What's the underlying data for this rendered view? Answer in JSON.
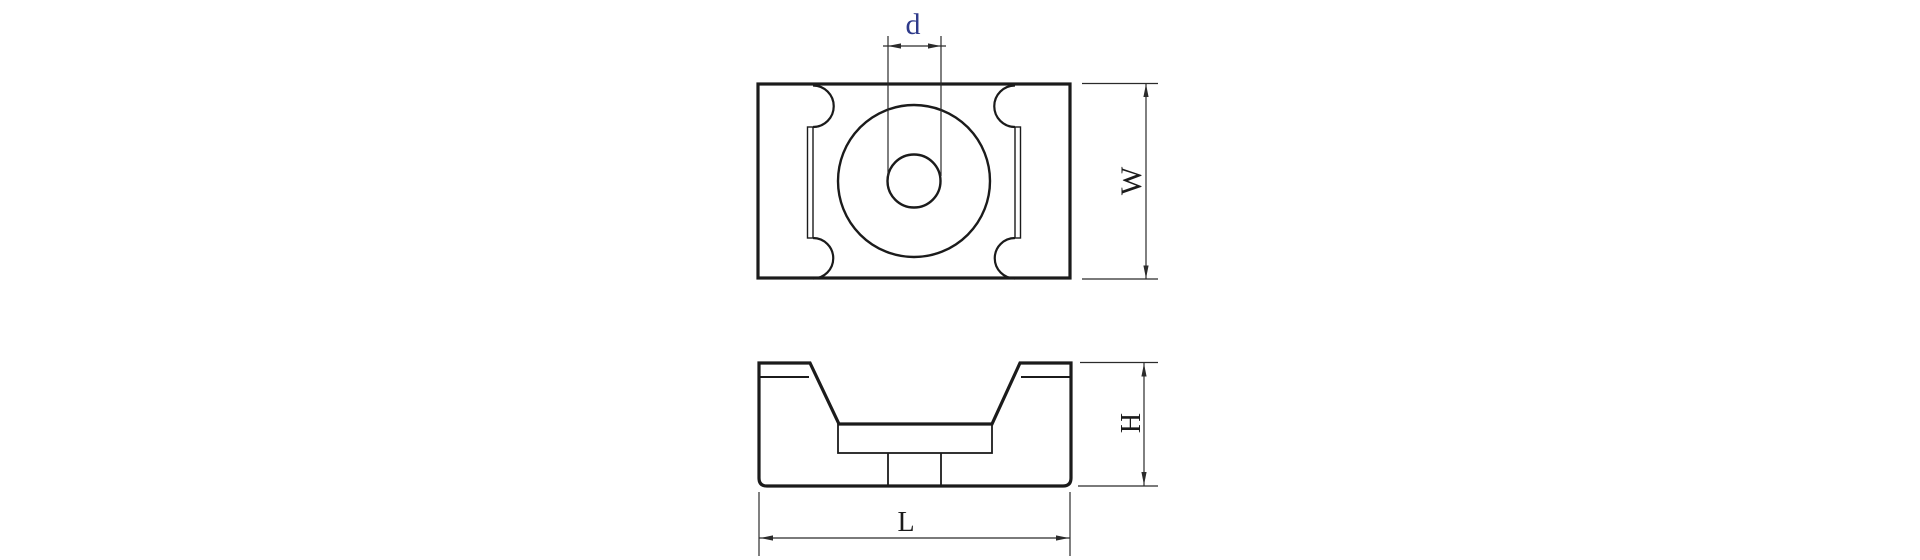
{
  "figure": {
    "background": "#ffffff",
    "line_color": "#1b1b1b",
    "dimension_line_color": "#2b2b2b"
  },
  "dims": {
    "d": {
      "label": "d",
      "color": "#2e3a8a"
    },
    "w": {
      "label": "W",
      "color": "#1b1b1b"
    },
    "h": {
      "label": "H",
      "color": "#1b1b1b"
    },
    "l": {
      "label": "L",
      "color": "#1b1b1b"
    }
  }
}
